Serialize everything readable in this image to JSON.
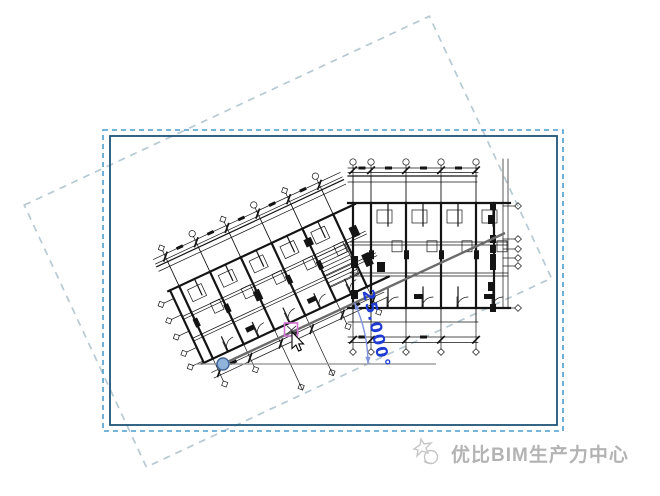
{
  "app_context": "BIM view canvas during a rotate-crop-region operation",
  "rotate_tool": {
    "angle_label": "25.000°",
    "angle_degrees": 25,
    "direction": "counterclockwise",
    "origin_icon": "rotation-origin-dot",
    "snap_icon": "square-snap-indicator",
    "cursor_icon": "arrow-cursor"
  },
  "crop_region": {
    "style": "dashed outer edge with solid inner boundary",
    "outer_dash_color": "#4a9dce",
    "inner_solid_color": "#1f5477"
  },
  "rotated_preview": {
    "style": "light dashed rectangle rotated with the tool",
    "dash_color": "#b7c9d2",
    "rotation_degrees": -25
  },
  "floor_plan": {
    "description": "two-wing residential floor plan, right wing orthogonal, left wing bent 25 degrees",
    "line_color": "#141414"
  },
  "watermark": {
    "text": "优比BIM生产力中心",
    "logo": "sketch-star-logo",
    "color": "#b3b3b3"
  },
  "colors": {
    "background": "#ffffff",
    "ink": "#141414",
    "angle_text": "#1e3bd2",
    "arc": "#8094de",
    "origin_fill": "#8fb3d9",
    "origin_stroke": "#44689a",
    "reference_line": "#8f8f8f",
    "ray": "#6b6b6b",
    "snap": "#d06fd0",
    "watermark": "#b3b3b3"
  }
}
